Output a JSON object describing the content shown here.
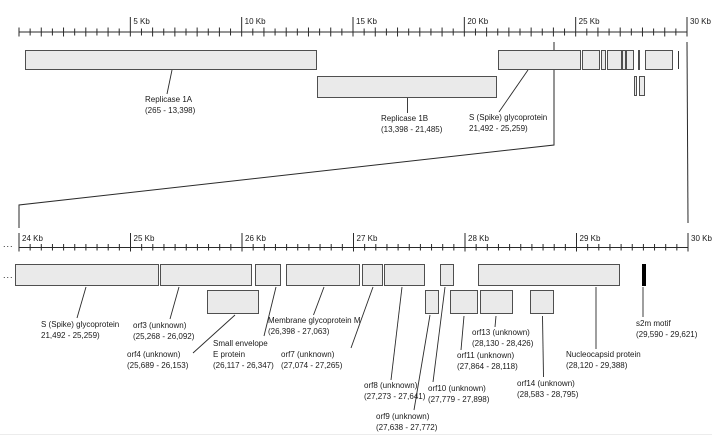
{
  "diagram": {
    "ellipsis": "...",
    "top_ruler": {
      "start_kb": 0,
      "end_kb": 30,
      "minor_step_kb": 0.5,
      "major_step_kb": 5,
      "major_labels": [
        "5 Kb",
        "10 Kb",
        "15 Kb",
        "20 Kb",
        "25 Kb",
        "30 Kb"
      ],
      "major_positions_kb": [
        5,
        10,
        15,
        20,
        25,
        30
      ]
    },
    "bottom_ruler": {
      "start_kb": 24,
      "end_kb": 30,
      "minor_step_kb": 0.1,
      "major_step_kb": 1,
      "major_labels": [
        "24 Kb",
        "25 Kb",
        "26 Kb",
        "27 Kb",
        "28 Kb",
        "29 Kb",
        "30 Kb"
      ],
      "major_positions_kb": [
        24,
        25,
        26,
        27,
        28,
        29,
        30
      ]
    },
    "features": [
      {
        "id": "rep1a",
        "name": "Replicase 1A",
        "start": 265,
        "end": 13398,
        "label_lines": [
          "Replicase 1A",
          "(265 - 13,398)"
        ]
      },
      {
        "id": "rep1b",
        "name": "Replicase 1B",
        "start": 13398,
        "end": 21485,
        "label_lines": [
          "Replicase 1B",
          "(13,398 - 21,485)"
        ]
      },
      {
        "id": "spike",
        "name": "S (Spike) glycoprotein",
        "start": 21492,
        "end": 25259,
        "label_lines": [
          "S (Spike) glycoprotein",
          "21,492 - 25,259)"
        ]
      },
      {
        "id": "orf3",
        "name": "orf3 (unknown)",
        "start": 25268,
        "end": 26092,
        "label_lines": [
          "orf3 (unknown)",
          "(25,268 - 26,092)"
        ]
      },
      {
        "id": "orf4",
        "name": "orf4 (unknown)",
        "start": 25689,
        "end": 26153,
        "label_lines": [
          "orf4 (unknown)",
          "(25,689 - 26,153)"
        ]
      },
      {
        "id": "e",
        "name": "Small envelope E protein",
        "start": 26117,
        "end": 26347,
        "label_lines": [
          "Small envelope",
          "E protein",
          "(26,117 - 26,347)"
        ]
      },
      {
        "id": "m",
        "name": "Membrane glycoprotein M",
        "start": 26398,
        "end": 27063,
        "label_lines": [
          "Membrane glycoprotein M",
          "(26,398 - 27,063)"
        ]
      },
      {
        "id": "orf7",
        "name": "orf7 (unknown)",
        "start": 27074,
        "end": 27265,
        "label_lines": [
          "orf7 (unknown)",
          "(27,074 - 27,265)"
        ]
      },
      {
        "id": "orf8",
        "name": "orf8 (unknown)",
        "start": 27273,
        "end": 27641,
        "label_lines": [
          "orf8 (unknown)",
          "(27,273 - 27,641)"
        ]
      },
      {
        "id": "orf9",
        "name": "orf9 (unknown)",
        "start": 27638,
        "end": 27772,
        "label_lines": [
          "orf9 (unknown)",
          "(27,638 - 27,772)"
        ]
      },
      {
        "id": "orf10",
        "name": "orf10 (unknown)",
        "start": 27779,
        "end": 27898,
        "label_lines": [
          "orf10 (unknown)",
          "(27,779 - 27,898)"
        ]
      },
      {
        "id": "orf11",
        "name": "orf11 (unknown)",
        "start": 27864,
        "end": 28118,
        "label_lines": [
          "orf11 (unknown)",
          "(27,864 - 28,118)"
        ]
      },
      {
        "id": "orf13",
        "name": "orf13 (unknown)",
        "start": 28130,
        "end": 28426,
        "label_lines": [
          "orf13 (unknown)",
          "(28,130 - 28,426)"
        ]
      },
      {
        "id": "orf14",
        "name": "orf14 (unknown)",
        "start": 28583,
        "end": 28795,
        "label_lines": [
          "orf14 (unknown)",
          "(28,583 - 28,795)"
        ]
      },
      {
        "id": "n",
        "name": "Nucleocapsid protein",
        "start": 28120,
        "end": 29388,
        "label_lines": [
          "Nucleocapsid protein",
          "(28,120 - 29,388)"
        ]
      },
      {
        "id": "s2m",
        "name": "s2m motif",
        "start": 29590,
        "end": 29621,
        "label_lines": [
          "s2m motif",
          "(29,590 - 29,621)"
        ]
      }
    ],
    "colors": {
      "box_fill": "#eaeaea",
      "box_border": "#4f4f4f",
      "line": "#2a2a2a",
      "s2m_fill": "#000000"
    }
  }
}
